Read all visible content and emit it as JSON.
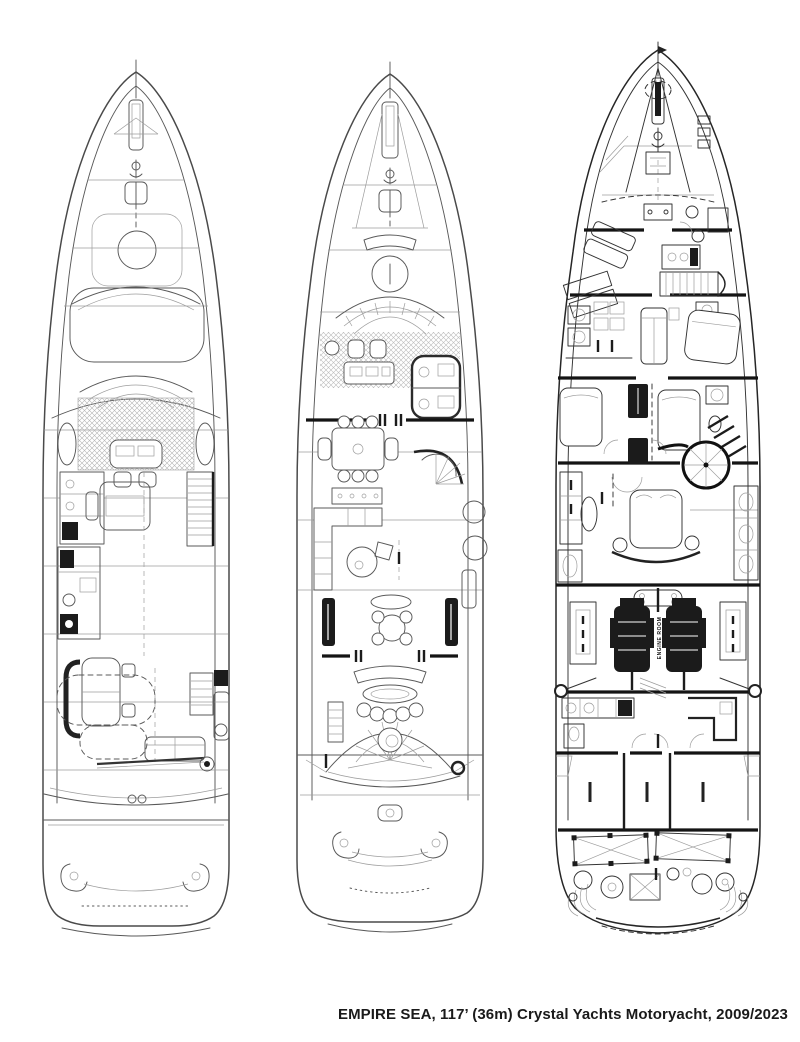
{
  "caption": {
    "text": "EMPIRE SEA, 117’ (36m) Crystal Yachts Motoryacht, 2009/2023"
  },
  "plans": {
    "lower_deck": {
      "engine_room_label": "ENGINE ROOM"
    }
  },
  "colors": {
    "paper": "#ffffff",
    "ink": "#4a4a4a",
    "ink_bold": "#141414",
    "hatch": "#b4b4b4",
    "caption_text": "#1a1a1a"
  }
}
